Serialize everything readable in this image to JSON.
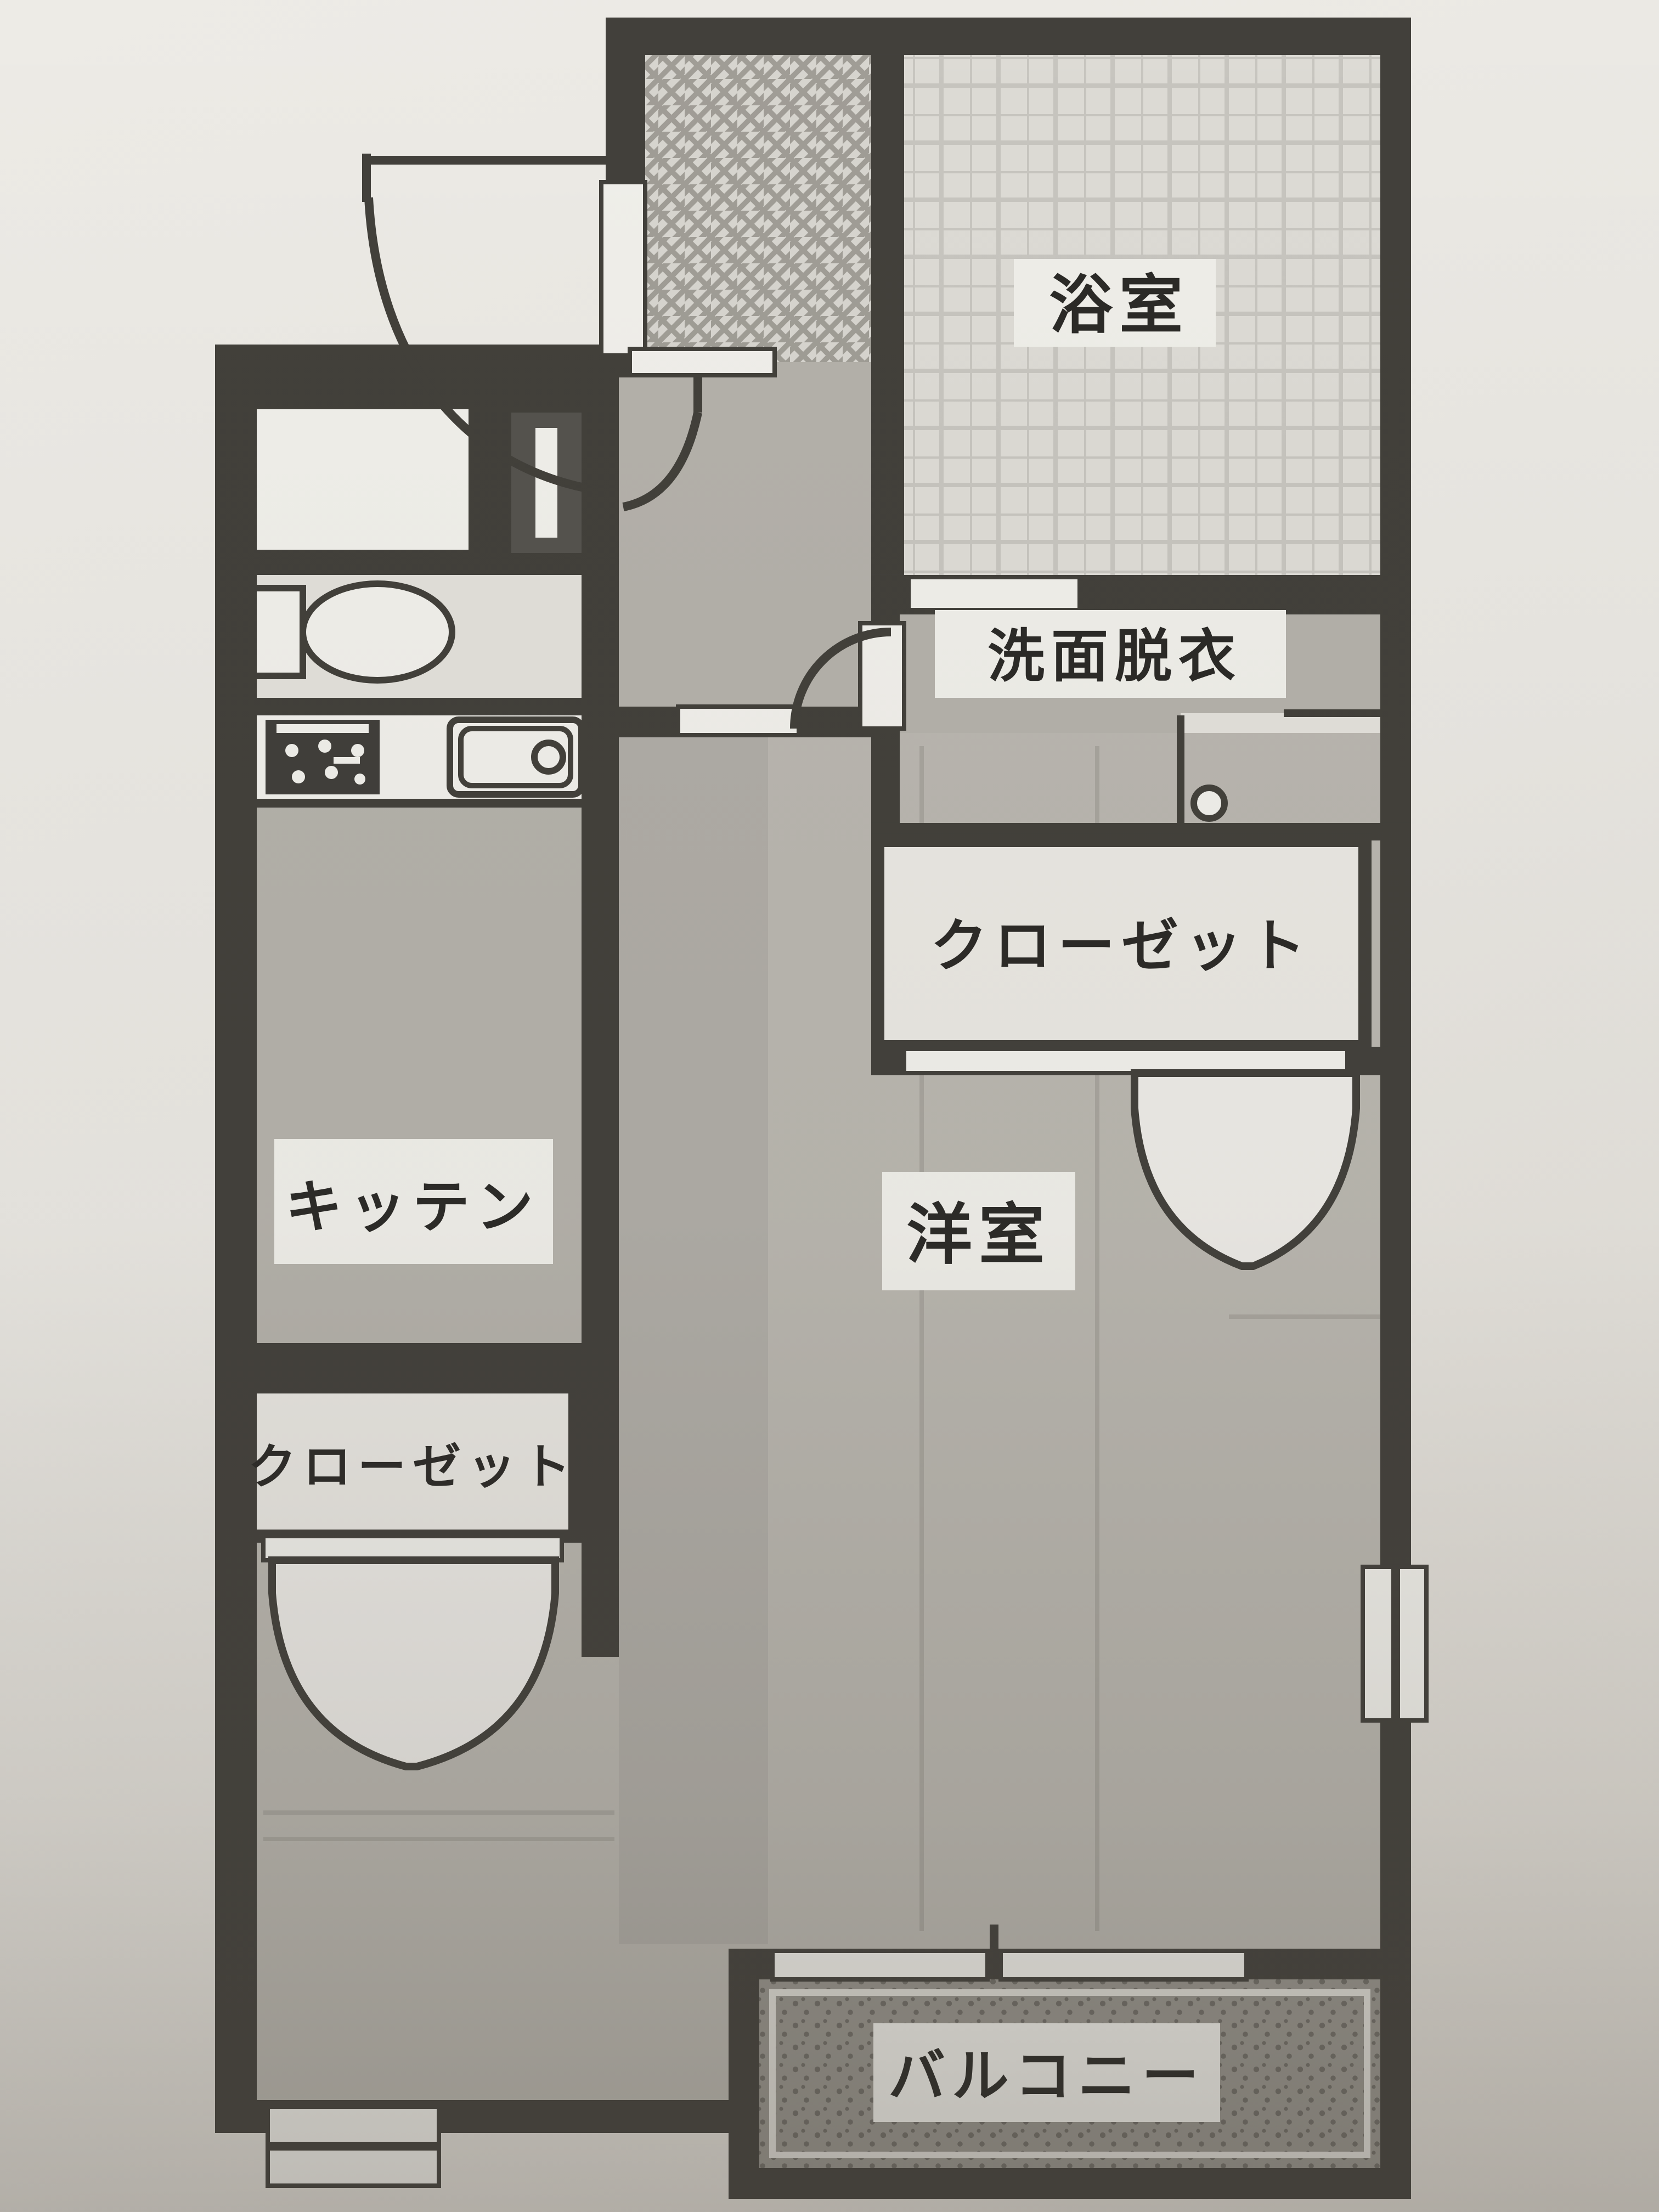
{
  "document": {
    "type": "apartment-floor-plan-photo",
    "language": "ja"
  },
  "rooms": {
    "bathroom": {
      "label": "浴室"
    },
    "washroom": {
      "label": "洗面脱衣"
    },
    "closet_right": {
      "label": "クローゼット"
    },
    "western_room": {
      "label": "洋室"
    },
    "kitchen": {
      "label": "キッテン"
    },
    "closet_left": {
      "label": "クローゼット"
    },
    "balcony": {
      "label": "バルコニー"
    }
  },
  "fixtures": [
    "entrance-door-swing",
    "genkan-tile-floor",
    "bathroom-tile-floor",
    "toilet",
    "washing-machine-space",
    "shoe-cabinet",
    "stove",
    "kitchen-sink",
    "washer-drain-circle",
    "interior-door-swing",
    "folding-closet-door",
    "sliding-balcony-door",
    "side-window",
    "bottom-window"
  ],
  "colors": {
    "paper": "#e9e7e2",
    "wall": "#42403b",
    "white": "#f0efea",
    "floor": "#b4b1aa",
    "floor-room": "#b9b6af",
    "floor-toilet": "#e2e0da",
    "genkan": "#d7d5cf",
    "genkan-line": "#a09d96",
    "bath": "#dddbd5",
    "bath-line": "#c7c5bf",
    "balcony": "#96938c",
    "balcony-dot": "#6f6c66",
    "label-bg": "#efeee9",
    "ink": "#2b2a27"
  }
}
